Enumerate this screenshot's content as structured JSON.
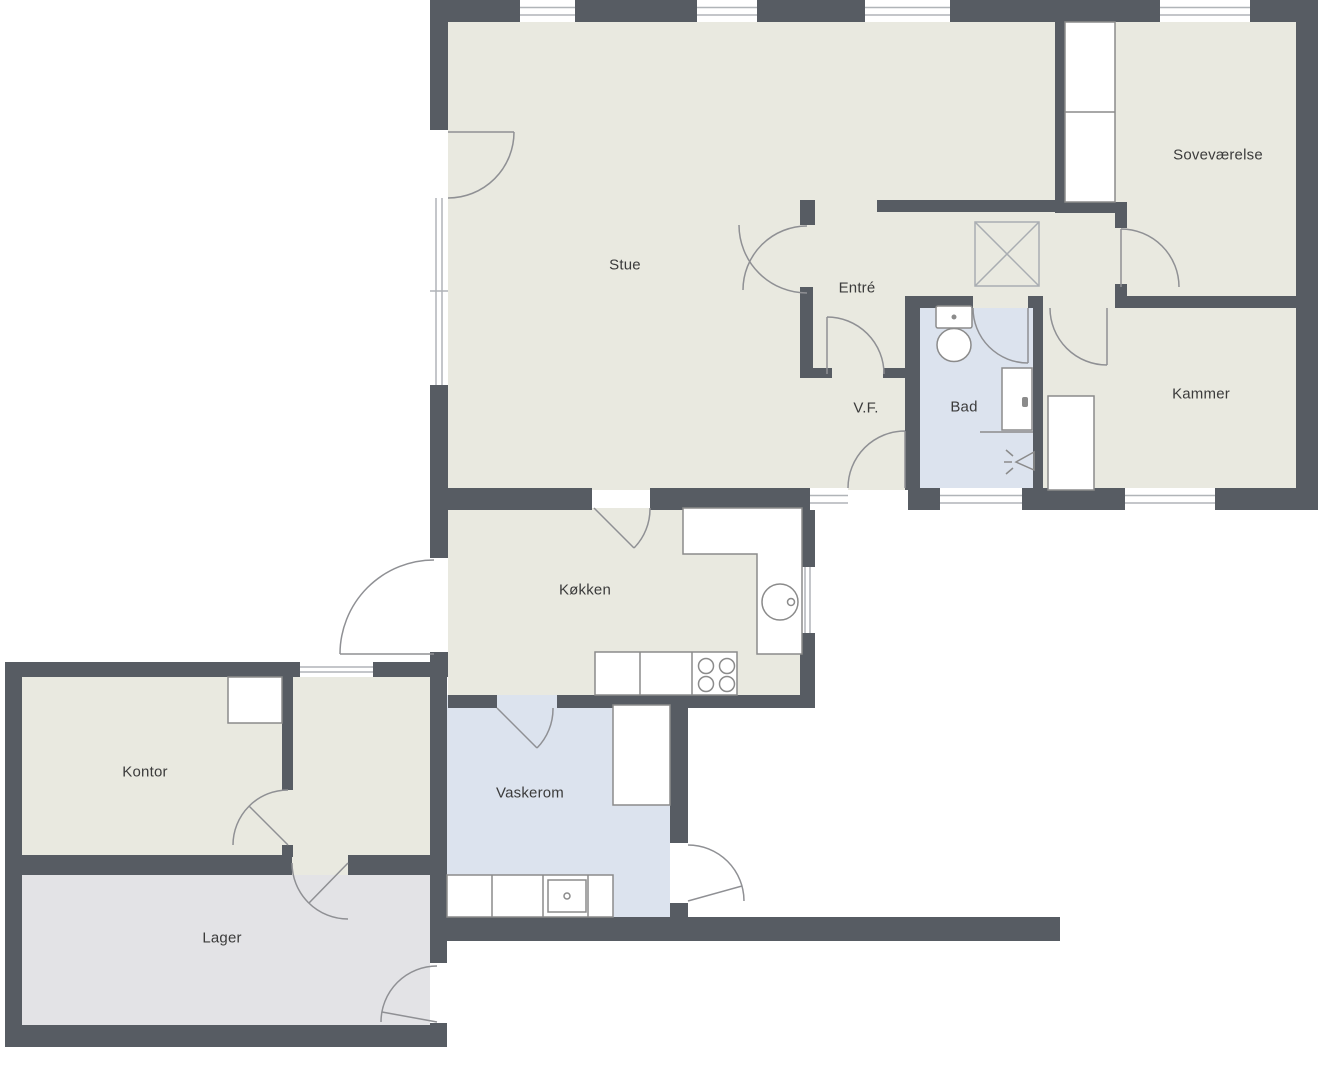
{
  "title": "Floor plan",
  "rooms": {
    "stue": {
      "label": "Stue"
    },
    "sovevaerelse": {
      "label": "Soveværelse"
    },
    "entre": {
      "label": "Entré"
    },
    "vf": {
      "label": "V.F."
    },
    "bad": {
      "label": "Bad"
    },
    "kammer": {
      "label": "Kammer"
    },
    "koekken": {
      "label": "Køkken"
    },
    "kontor": {
      "label": "Kontor"
    },
    "vaskerom": {
      "label": "Vaskerom"
    },
    "lager": {
      "label": "Lager"
    }
  },
  "fixtures": [
    "wardrobe",
    "skylight",
    "toilet",
    "shower-door",
    "shower-head",
    "cabinet",
    "kitchen-counter",
    "kitchen-sink",
    "stove",
    "laundry-counter",
    "laundry-sink",
    "kontor-box"
  ],
  "colors": {
    "wall": "#575c63",
    "floor_main": "#e9e9e0",
    "floor_wet": "#dce3ee",
    "floor_storage": "#e3e3e6",
    "fixture_line": "#8b8b8b",
    "window_line": "#b0b4b8",
    "text": "#3b3b3b",
    "background": "#ffffff"
  }
}
